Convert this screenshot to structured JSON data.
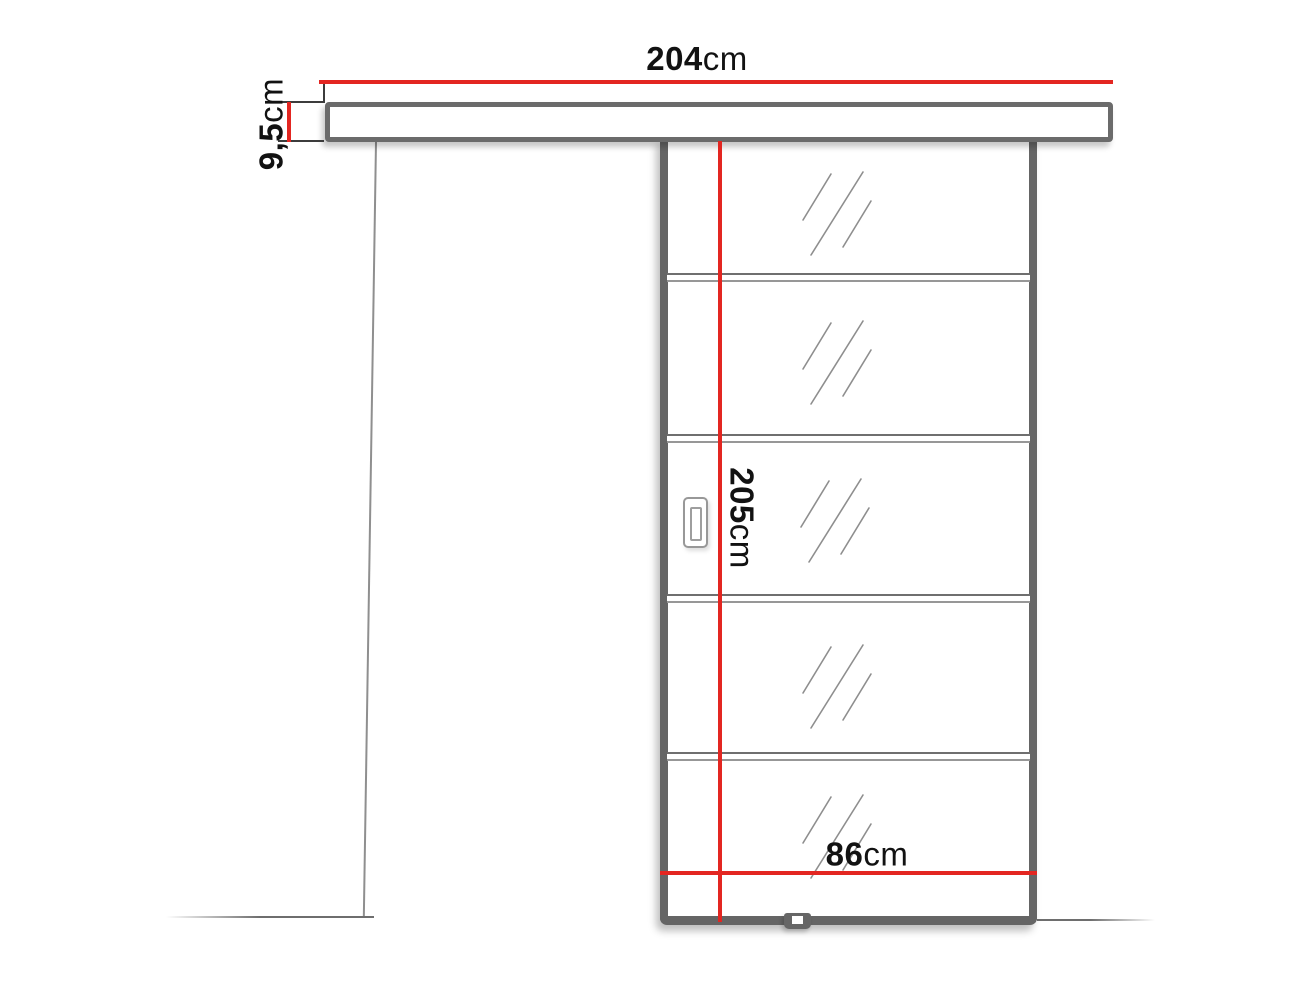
{
  "measurements": {
    "rail_width": {
      "value": "204",
      "unit": "cm"
    },
    "rail_height": {
      "value": "9,5",
      "unit": "cm"
    },
    "door_height": {
      "value": "205",
      "unit": "cm"
    },
    "door_width": {
      "value": "86",
      "unit": "cm"
    }
  },
  "colors": {
    "dimension_line": "#e32621",
    "outline_gray": "#6b6b6b",
    "sketch_gray": "#8e8e8e",
    "label_text": "#121212",
    "background": "#ffffff"
  }
}
